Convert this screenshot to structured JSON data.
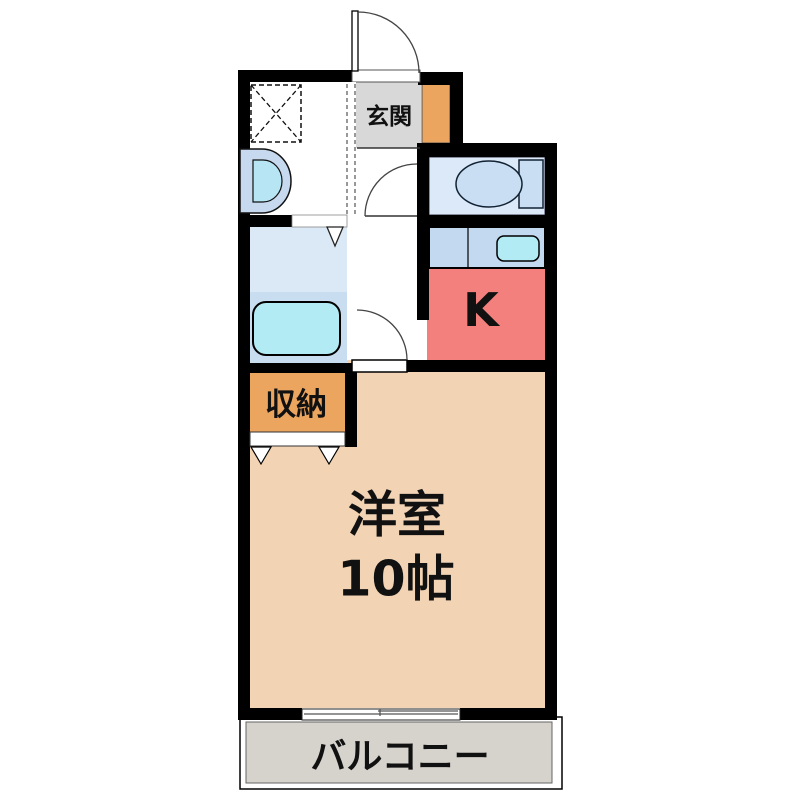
{
  "plan": {
    "type": "apartment-floor-plan",
    "labels": {
      "entrance": "玄関",
      "kitchen": "K",
      "storage": "収納",
      "main_room_name": "洋室",
      "main_room_size": "10帖",
      "balcony": "バルコニー"
    },
    "colors": {
      "wall": "#000000",
      "main_room": "#f2d3b4",
      "kitchen": "#f4807d",
      "storage": "#eba55f",
      "shoe_cabinet": "#eba55f",
      "entrance_floor": "#d8d8d8",
      "corridor_floor": "#ffffff",
      "washroom_floor": "#ffffff",
      "balcony_deck": "#d6d2cc",
      "toilet_floor": "#dce9f8",
      "bathroom_upper": "#dbe9f6",
      "bathroom_lower": "#c9ddf1",
      "kitchen_counter": "#c3d9f0",
      "bathtub": "#b3ebf4",
      "kitchen_sink": "#b3ebf4",
      "washbasin_outer": "#c6d9ee",
      "washbasin_inner": "#b7e5f3",
      "toilet_fixture": "#c9def2"
    }
  }
}
